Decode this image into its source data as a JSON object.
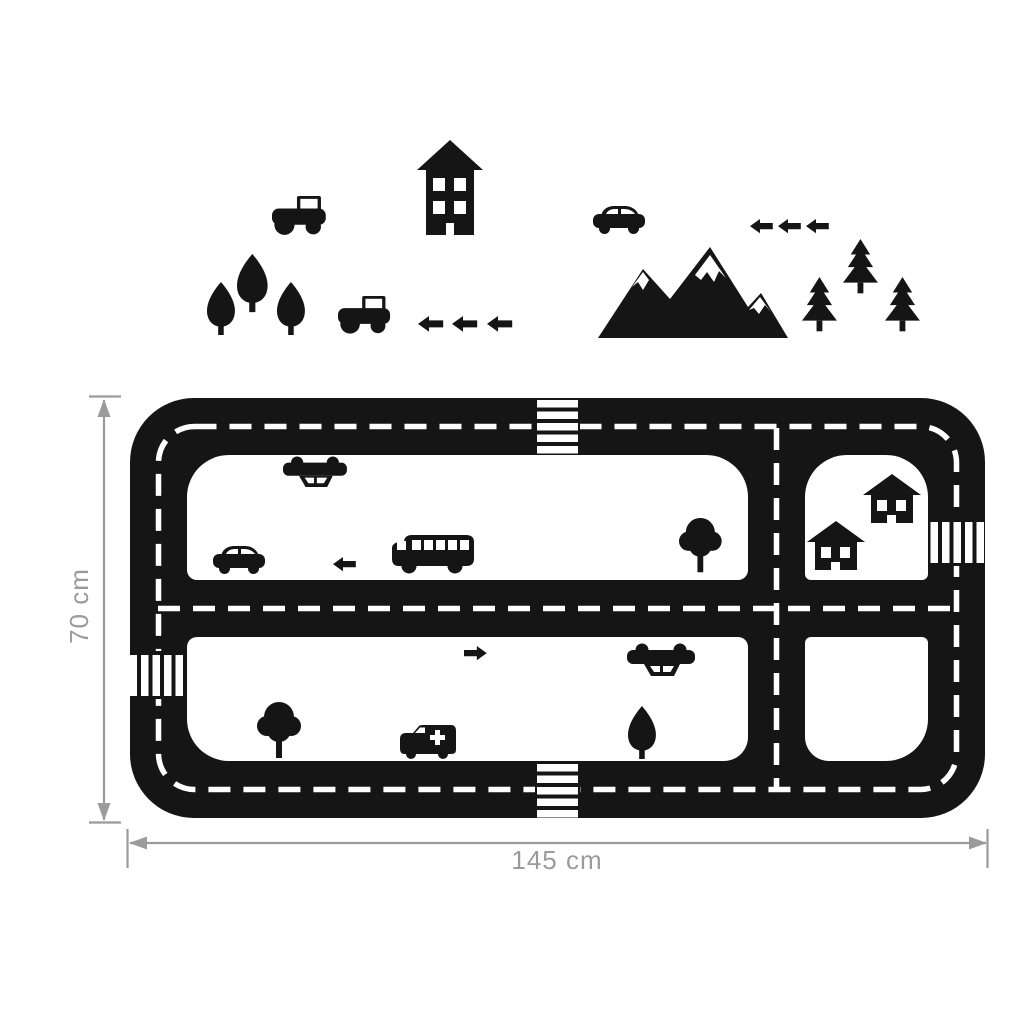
{
  "colors": {
    "silhouette": "#151515",
    "dimension": "#9b9b9b",
    "background": "#ffffff",
    "marking": "#ffffff"
  },
  "dimensions": {
    "height_label": "70 cm",
    "width_label": "145 cm"
  },
  "top_scene_items": [
    "tractor",
    "tall-house",
    "tree-teardrop",
    "tree-teardrop",
    "tree-teardrop",
    "tractor",
    "arrow-left",
    "arrow-left",
    "arrow-left",
    "car",
    "arrow-left",
    "arrow-left",
    "arrow-left",
    "snowcapped-mountains",
    "pine-tree",
    "pine-tree",
    "pine-tree"
  ],
  "track": {
    "zebra_crossings": 4,
    "road_style": "black road with white dashed center lines",
    "interior_items": [
      "upside-down-car",
      "car",
      "arrow-left",
      "school-bus",
      "round-tree",
      "small-house",
      "small-house",
      "arrow-right",
      "upside-down-car",
      "round-tree",
      "ambulance",
      "tree-teardrop"
    ]
  }
}
